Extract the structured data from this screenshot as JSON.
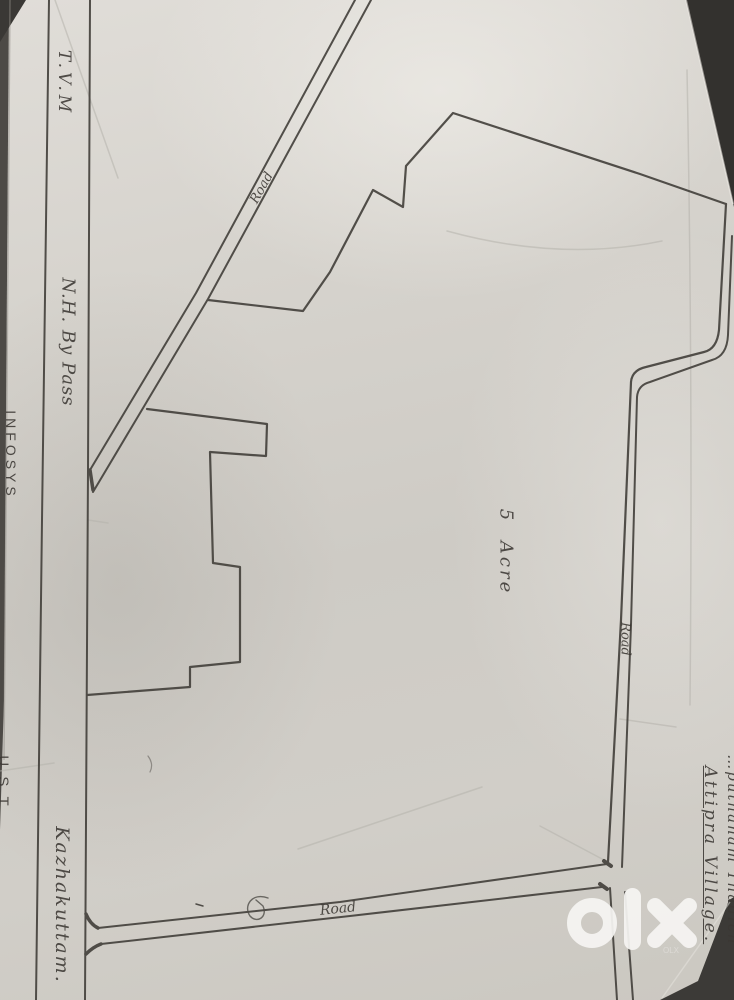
{
  "labels": {
    "tvm": "T.V.M",
    "nh_bypass": "N.H. By Pass",
    "infosys": "INFOSYS",
    "ust": "U.S.T",
    "kazhakuttam": "Kazhakuttam.",
    "acreage": "5 Acre",
    "road_diagonal": "Road",
    "road_right": "Road",
    "road_bottom": "Road",
    "village": "Attipra Village.",
    "village_area_note": "…puthanam Thadich"
  },
  "watermark": {
    "brand": "olx",
    "sub": "OLX"
  },
  "colors": {
    "ink": "#45423d",
    "paper": "#d2cfc9",
    "photo_background": "#33312e",
    "watermark": "#f6f5f3"
  },
  "map": {
    "type": "hand-drawn land sketch",
    "plot_area": "5 Acre",
    "roads": [
      "N.H. By Pass",
      "diagonal access road",
      "east side road",
      "south side road"
    ],
    "landmarks": [
      "INFOSYS",
      "U.S.T",
      "Kazhakuttam",
      "T.V.M",
      "Attipra Village"
    ]
  }
}
